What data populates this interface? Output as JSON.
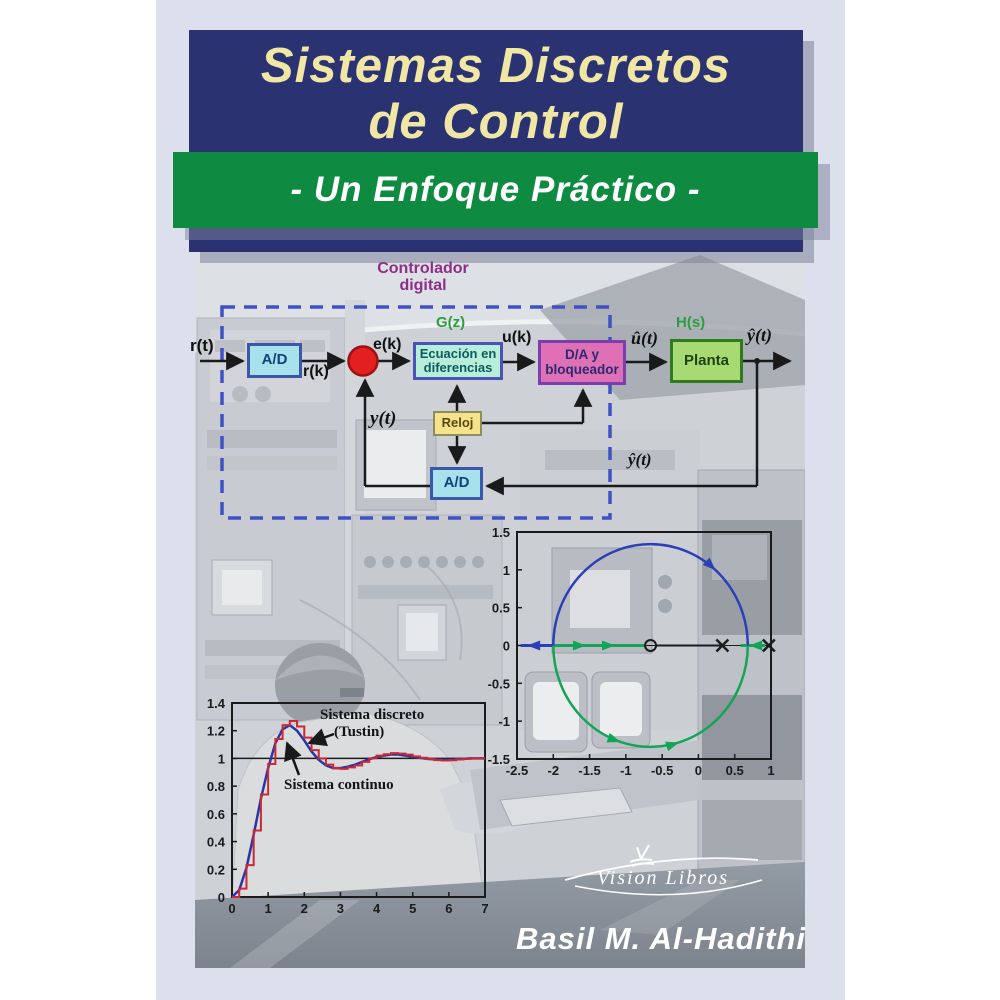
{
  "page": {
    "bg": "#ffffff",
    "cover_bg": "#dcdfec"
  },
  "title_block": {
    "line1": "Sistemas Discretos",
    "line2": "de Control",
    "bg": "#2b3272",
    "text_color": "#f0e7a5"
  },
  "subtitle_banner": {
    "text": "- Un Enfoque Práctico -",
    "bg": "#0e8a41",
    "text_color": "#ffffff"
  },
  "author": "Basil M. Al-Hadithi",
  "publisher": "Vision Libros",
  "diagram": {
    "caption": {
      "line1": "Controlador",
      "line2": "digital",
      "color": "#8d2f86"
    },
    "green_label_color": "#2b9e3f",
    "dashed_box_color": "#3f51c4",
    "sum_junction_fill": "#e32020",
    "sum_junction_border": "#9c1212",
    "signals": {
      "rt": "r(t)",
      "rk": "r(k)",
      "ek": "e(k)",
      "gz": "G(z)",
      "uk": "u(k)",
      "uhat": "û(t)",
      "hs": "H(s)",
      "yhat_out": "ŷ(t)",
      "yt": "y(t)",
      "yhat_fb": "ŷ(t)"
    },
    "blocks": {
      "ad1": {
        "label": "A/D",
        "fill": "#a7e1eb",
        "border": "#3a57a8",
        "text": "#14407e"
      },
      "eq": {
        "label1": "Ecuación en",
        "label2": "diferencias",
        "fill": "#b6eed9",
        "border": "#4a52b4",
        "text": "#0d5a60"
      },
      "da": {
        "label1": "D/A y",
        "label2": "bloqueador",
        "fill": "#df70b5",
        "border": "#7a3fae",
        "text": "#2a2a70"
      },
      "planta": {
        "label": "Planta",
        "fill": "#a8da73",
        "border": "#2f7a1e",
        "text": "#1e420e"
      },
      "reloj": {
        "label": "Reloj",
        "fill": "#f4e38a",
        "border": "#8f8c60",
        "text": "#5a4a10"
      },
      "ad2": {
        "label": "A/D",
        "fill": "#a7e1eb",
        "border": "#3a57a8",
        "text": "#14407e"
      }
    }
  },
  "chart_data": [
    {
      "type": "line",
      "title": "",
      "xlabel": "",
      "ylabel": "",
      "xlim": [
        0,
        7
      ],
      "ylim": [
        0,
        1.4
      ],
      "xticks": [
        0,
        1,
        2,
        3,
        4,
        5,
        6,
        7
      ],
      "xtick_labels": [
        "0",
        "1",
        "2",
        "3",
        "4",
        "5",
        "6",
        "7"
      ],
      "yticks": [
        0,
        0.2,
        0.4,
        0.6,
        0.8,
        1,
        1.2,
        1.4
      ],
      "ytick_labels": [
        "0",
        "0.2",
        "0.4",
        "0.6",
        "0.8",
        "1",
        "1.2",
        "1.4"
      ],
      "ref_line_y": 1,
      "annotations": [
        {
          "text": "Sistema discreto"
        },
        {
          "text": "(Tustin)"
        },
        {
          "text": "Sistema continuo"
        }
      ],
      "series": [
        {
          "name": "Sistema continuo",
          "color": "#2a35a8",
          "style": "line",
          "x": [
            0,
            0.2,
            0.4,
            0.6,
            0.8,
            1.0,
            1.2,
            1.4,
            1.6,
            1.8,
            2.0,
            2.2,
            2.4,
            2.6,
            2.8,
            3.0,
            3.2,
            3.4,
            3.6,
            3.8,
            4.0,
            4.2,
            4.4,
            4.6,
            4.8,
            5.0,
            5.2,
            5.4,
            5.6,
            5.8,
            6.0,
            6.2,
            6.4,
            6.6,
            6.8,
            7.0
          ],
          "y": [
            0,
            0.05,
            0.21,
            0.45,
            0.71,
            0.93,
            1.11,
            1.21,
            1.24,
            1.2,
            1.13,
            1.05,
            0.99,
            0.95,
            0.93,
            0.93,
            0.94,
            0.955,
            0.975,
            0.995,
            1.01,
            1.02,
            1.028,
            1.028,
            1.02,
            1.012,
            1.004,
            0.998,
            0.993,
            0.99,
            0.99,
            0.993,
            0.997,
            1.0,
            1.0,
            1.0
          ]
        },
        {
          "name": "Sistema discreto (Tustin)",
          "color": "#cc2832",
          "style": "staircase",
          "x": [
            0,
            0.2,
            0.4,
            0.6,
            0.8,
            1.0,
            1.2,
            1.4,
            1.6,
            1.8,
            2.0,
            2.2,
            2.4,
            2.6,
            2.8,
            3.0,
            3.2,
            3.4,
            3.6,
            3.8,
            4.0,
            4.2,
            4.4,
            4.6,
            4.8,
            5.0,
            5.2,
            5.4,
            5.6,
            5.8,
            6.0,
            6.2,
            6.4,
            6.6,
            6.8,
            7.0
          ],
          "y": [
            0,
            0.06,
            0.23,
            0.48,
            0.74,
            0.96,
            1.14,
            1.24,
            1.27,
            1.23,
            1.15,
            1.06,
            1.0,
            0.955,
            0.93,
            0.925,
            0.935,
            0.95,
            0.975,
            1.0,
            1.02,
            1.03,
            1.038,
            1.035,
            1.027,
            1.015,
            1.005,
            0.995,
            0.988,
            0.985,
            0.987,
            0.992,
            0.997,
            1.0,
            1.0,
            1.0
          ]
        }
      ]
    },
    {
      "type": "scatter",
      "subtype": "root_locus",
      "title": "",
      "xlim": [
        -2.5,
        1
      ],
      "ylim": [
        -1.5,
        1.5
      ],
      "xticks": [
        -2.5,
        -2,
        -1.5,
        -1,
        -0.5,
        0,
        0.5,
        1
      ],
      "xtick_labels": [
        "-2.5",
        "-2",
        "-1.5",
        "-1",
        "-0.5",
        "0",
        "0.5",
        "1"
      ],
      "yticks": [
        1.5,
        1,
        0.5,
        0,
        -0.5,
        -1,
        -1.5
      ],
      "ytick_labels": [
        "1.5",
        "1",
        "0.5",
        "0",
        "-0.5",
        "-1",
        "-1.5"
      ],
      "poles": [
        [
          0.33,
          0
        ],
        [
          0.97,
          0
        ]
      ],
      "zeros": [
        [
          -0.66,
          0
        ]
      ],
      "circle": {
        "center": [
          -0.66,
          0
        ],
        "radius": 1.34,
        "upper_color": "#2a3fb8",
        "lower_color": "#12a457"
      },
      "real_axis_segments": [
        {
          "from": -2.45,
          "to": -2.0,
          "color": "#2a3fb8",
          "width": 3
        },
        {
          "from": -2.0,
          "to": -0.72,
          "color": "#12a457",
          "width": 3
        },
        {
          "from": -0.6,
          "to": 0.33,
          "color": "#1b1b1b",
          "width": 2
        },
        {
          "from": 0.58,
          "to": 0.92,
          "color": "#12a457",
          "width": 3
        }
      ],
      "axis_arrows": [
        {
          "x": -2.36,
          "dir": "left",
          "color": "#2a3fb8"
        },
        {
          "x": -1.55,
          "dir": "right",
          "color": "#12a457"
        },
        {
          "x": -1.15,
          "dir": "right",
          "color": "#12a457"
        },
        {
          "x": 0.7,
          "dir": "left",
          "color": "#12a457"
        }
      ],
      "arc_arrows": [
        {
          "theta_deg": 48,
          "color": "#2a3fb8"
        },
        {
          "theta_deg": 252,
          "color": "#12a457"
        },
        {
          "theta_deg": 287,
          "color": "#12a457"
        }
      ]
    }
  ]
}
